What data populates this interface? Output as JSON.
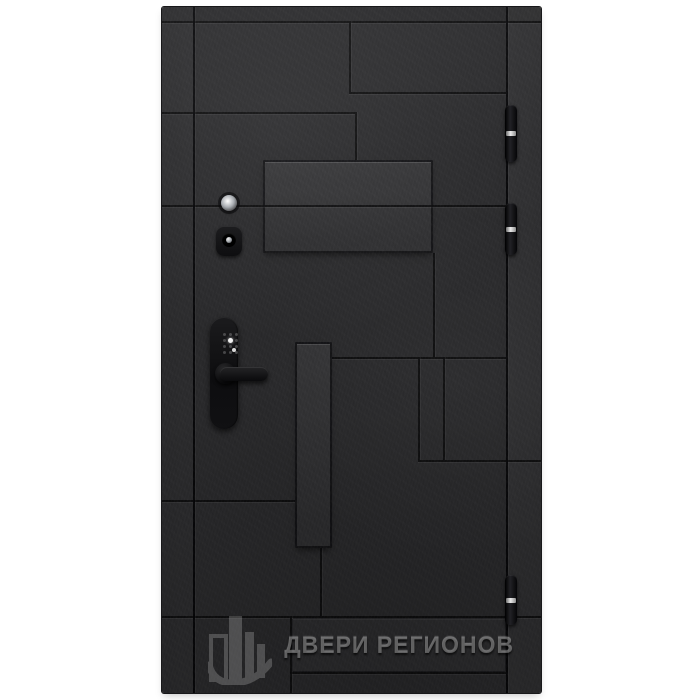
{
  "page": {
    "background": "#ffffff"
  },
  "brand": {
    "text": "ДВЕРИ РЕГИОНОВ",
    "logo_icon": "buildings-logo-icon",
    "watermark_color": "#a9a9a9"
  },
  "door": {
    "colors": {
      "leaf": "#2b2b2d",
      "groove": "#09090b",
      "raised_panel": "#343437",
      "hinge_body": "#111113",
      "hinge_band": "#e0e0e0",
      "hardware": "#141416",
      "metal": "#b9bdc2",
      "background": "#ffffff"
    },
    "box": {
      "left": 162,
      "top": 7,
      "width": 379,
      "height": 686
    },
    "pattern": {
      "grooves_h": [
        {
          "y": 14,
          "x": 0,
          "w": 379
        },
        {
          "y": 85,
          "x": 187,
          "w": 157
        },
        {
          "y": 105,
          "x": 0,
          "w": 193
        },
        {
          "y": 198,
          "x": 0,
          "w": 344
        },
        {
          "y": 350,
          "x": 170,
          "w": 174
        },
        {
          "y": 453,
          "x": 256,
          "w": 123
        },
        {
          "y": 493,
          "x": 0,
          "w": 133
        },
        {
          "y": 609,
          "x": 0,
          "w": 379
        },
        {
          "y": 665,
          "x": 128,
          "w": 216
        }
      ],
      "grooves_v": [
        {
          "x": 31,
          "y": 0,
          "h": 686,
          "seam": true
        },
        {
          "x": 344,
          "y": 0,
          "h": 686,
          "seam": true
        },
        {
          "x": 187,
          "y": 14,
          "h": 71
        },
        {
          "x": 193,
          "y": 105,
          "h": 48
        },
        {
          "x": 271,
          "y": 246,
          "h": 104
        },
        {
          "x": 256,
          "y": 350,
          "h": 103
        },
        {
          "x": 281,
          "y": 350,
          "h": 103
        },
        {
          "x": 158,
          "y": 541,
          "h": 68
        },
        {
          "x": 128,
          "y": 609,
          "h": 77
        }
      ],
      "raised_panels": [
        {
          "x": 101,
          "y": 153,
          "w": 170,
          "h": 93
        },
        {
          "x": 133,
          "y": 335,
          "w": 37,
          "h": 206
        },
        {
          "x": 130,
          "y": 611,
          "w": 214,
          "h": 54,
          "subtle": true
        }
      ]
    },
    "hinges": {
      "x": 343,
      "w": 12,
      "items": [
        {
          "y": 98,
          "h": 57,
          "band": 26
        },
        {
          "y": 196,
          "h": 52,
          "band": 24
        },
        {
          "y": 568,
          "h": 50,
          "band": 23
        }
      ]
    },
    "keypad": {
      "cols": [
        62,
        68,
        74
      ],
      "rows": [
        327,
        333,
        339,
        345
      ],
      "bright": [
        {
          "x": 68,
          "y": 333,
          "type": "star"
        },
        {
          "x": 72,
          "y": 343,
          "type": "lit"
        }
      ]
    }
  }
}
